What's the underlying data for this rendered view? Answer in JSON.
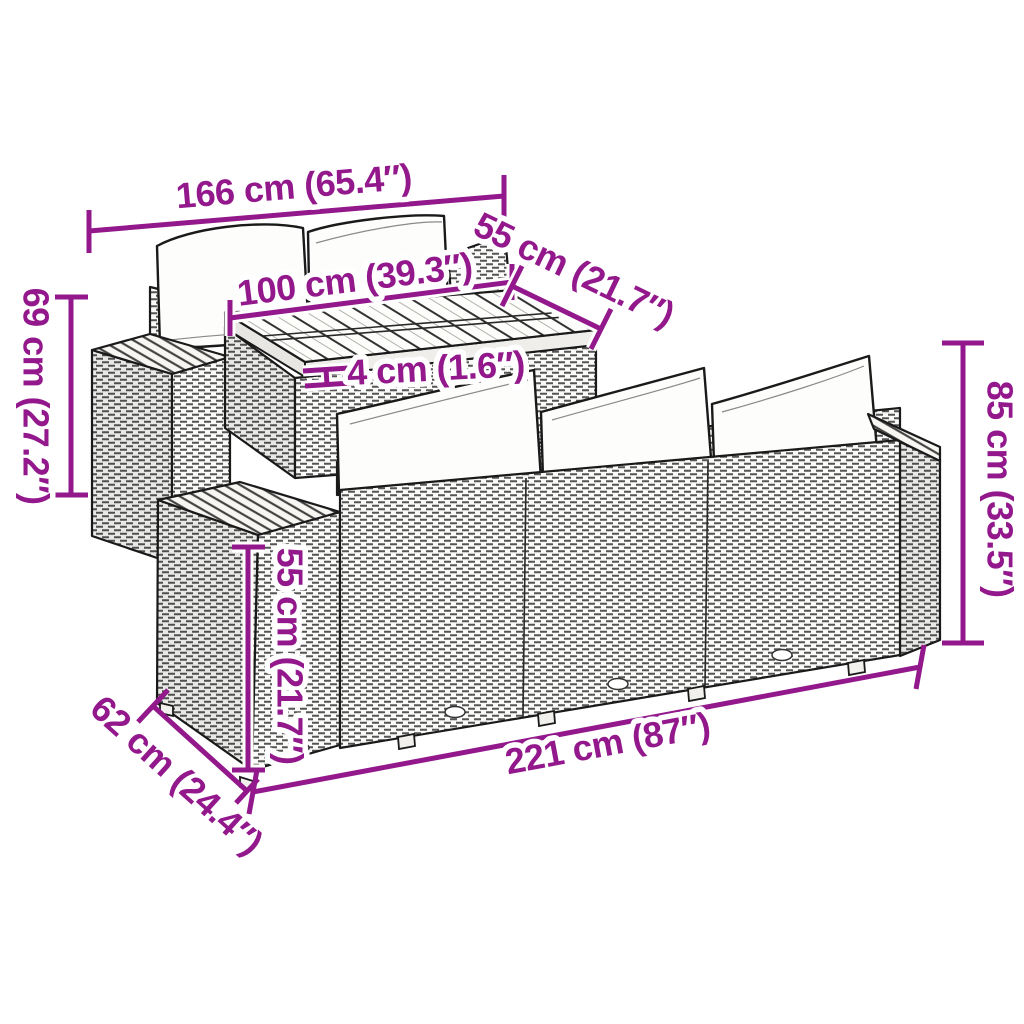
{
  "colors": {
    "dimension_annotation": "#92188C",
    "line_art": "#1a1a1a",
    "background": "#ffffff",
    "cushion": "#ffffff"
  },
  "illustration": {
    "description": "Black line-art drawing of a poly rattan garden lounge set: corner sofa with two white back cushions, wooden slatted-top table, ottoman section, and a three-seater sofa with three white back cushions"
  },
  "dimensions": [
    {
      "name": "total-width",
      "label": "166 cm (65.4″)"
    },
    {
      "name": "table-top-width",
      "label": "55 cm (21.7″)"
    },
    {
      "name": "table-top-length",
      "label": "100 cm (39.3″)"
    },
    {
      "name": "table-top-thickness",
      "label": "4 cm (1.6″)"
    },
    {
      "name": "left-section-height",
      "label": "69 cm (27.2″)"
    },
    {
      "name": "sofa-height",
      "label": "85 cm (33.5″)"
    },
    {
      "name": "seat-height",
      "label": "55 cm (21.7″)"
    },
    {
      "name": "seat-depth",
      "label": "62 cm (24.4″)"
    },
    {
      "name": "sofa-length",
      "label": "221 cm (87″)"
    }
  ]
}
